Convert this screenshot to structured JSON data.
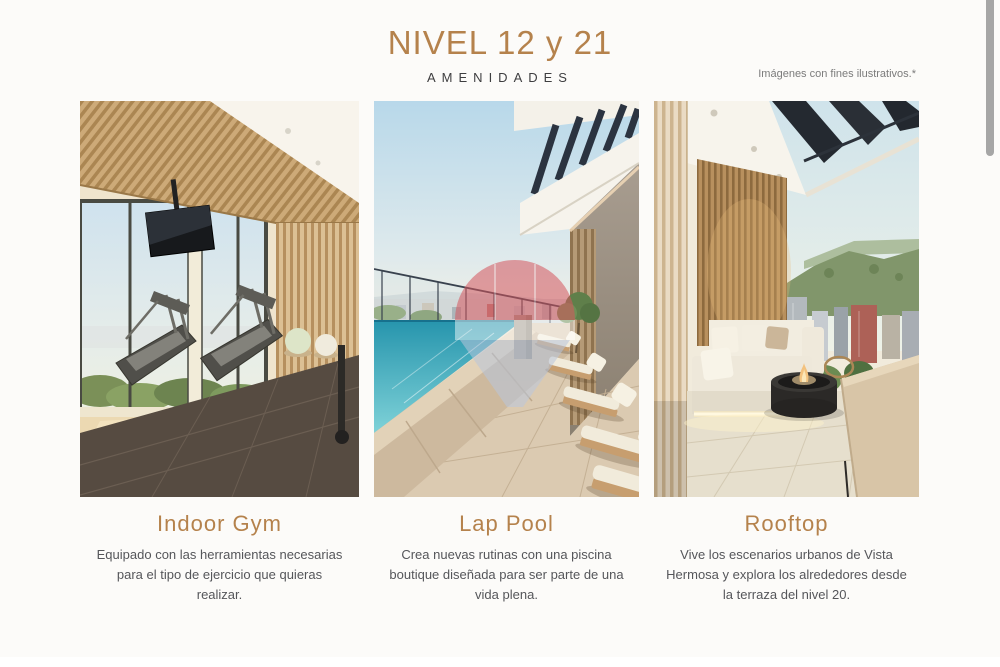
{
  "header": {
    "title": "NIVEL 12 y 21",
    "subtitle": "AMENIDADES",
    "disclaimer": "Imágenes con fines ilustrativos.*"
  },
  "cards": [
    {
      "id": "indoor-gym",
      "title": "Indoor Gym",
      "description": "Equipado con las herramientas necesarias para el tipo de ejercicio que quieras realizar."
    },
    {
      "id": "lap-pool",
      "title": "Lap Pool",
      "description": "Crea nuevas rutinas con una piscina boutique diseñada para ser parte de una vida plena."
    },
    {
      "id": "rooftop",
      "title": "Rooftop",
      "description": "Vive los escenarios urbanos de Vista Hermosa y explora los alrededores desde la terraza del nivel 20."
    }
  ],
  "watermark": {
    "icon": "remax-balloon-watermark",
    "colors": {
      "top": "#d5565e",
      "band": "#ffffff",
      "bottom": "#b9c6dc"
    }
  },
  "colors": {
    "accent": "#b5824c",
    "background": "#fcfbf9",
    "subtitle_text": "#3e3e40",
    "body_text": "#55565a",
    "disclaimer_text": "#7b7b7b",
    "scrollbar": "#a6a6a6"
  }
}
